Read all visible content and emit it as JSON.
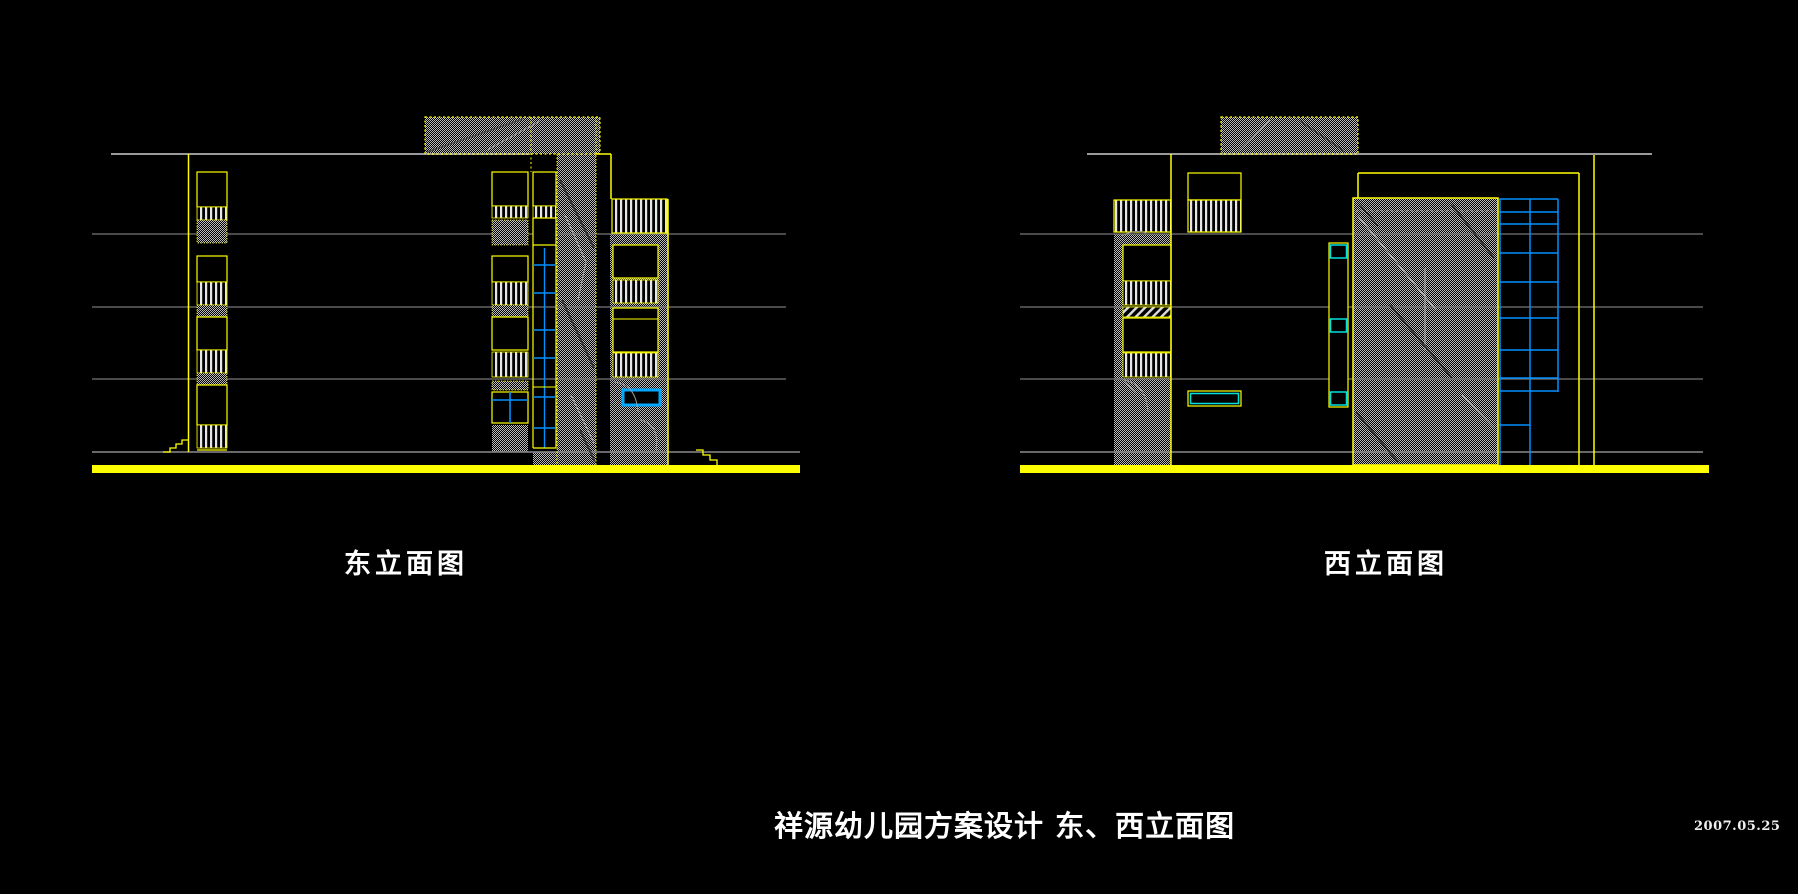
{
  "page": {
    "background_color": "#000000"
  },
  "drawing": {
    "east": {
      "label": "东立面图"
    },
    "west": {
      "label": "西立面图"
    },
    "sheet_title": "祥源幼儿园方案设计 东、西立面图",
    "date": "2007.05.25"
  },
  "colors": {
    "cad_yellow": "#ffff00",
    "cad_gray_line": "#7f7f7f",
    "cad_hatch_gray": "#bdbdbd",
    "cad_blue": "#0091ff",
    "cad_bright_blue": "#00a8ff",
    "cad_cyan": "#00e0e0",
    "text_white": "#ffffff",
    "background": "#000000"
  }
}
